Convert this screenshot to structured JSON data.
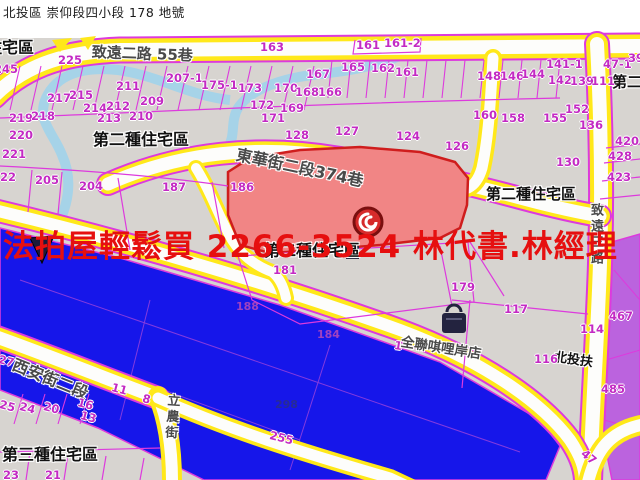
{
  "header": {
    "title": "北投區 崇仰段四小段 178 地號"
  },
  "overlay_ad": {
    "text": "法拍屋輕鬆買  2266-3524  林代書.林經理",
    "color": "#e60f0f"
  },
  "map": {
    "colors": {
      "parcel_line": "#dd3add",
      "road_yellow": "#ffe81a",
      "road_white": "#fdfdfb",
      "river_blue": "#1616ea",
      "creek_blue": "#a6d3e8",
      "block_gray": "#d7d4d0",
      "highlight_fill": "#f18585",
      "highlight_border": "#cf1d1d",
      "zone_purple": "#bb63de",
      "number_magenta": "#c32ac3"
    },
    "zone_labels": [
      {
        "text": "住宅區",
        "x": -14,
        "y": 40,
        "size": 16,
        "rot": 0
      },
      {
        "text": "第二種住宅區",
        "x": 93,
        "y": 132,
        "size": 16,
        "rot": 0
      },
      {
        "text": "第二種住宅區",
        "x": 264,
        "y": 243,
        "size": 16,
        "rot": 0
      },
      {
        "text": "第二種住宅區",
        "x": 486,
        "y": 187,
        "size": 15,
        "rot": 0
      },
      {
        "text": "第二",
        "x": 612,
        "y": 75,
        "size": 15,
        "rot": 0
      },
      {
        "text": "第三種住宅區",
        "x": 2,
        "y": 447,
        "size": 16,
        "rot": 0
      },
      {
        "text": "北投扶",
        "x": 555,
        "y": 351,
        "size": 13,
        "rot": 8
      }
    ],
    "street_labels": [
      {
        "text": "致遠二路 55巷",
        "x": 92,
        "y": 45,
        "size": 15,
        "rot": 2,
        "vert": false
      },
      {
        "text": "東華街二段374巷",
        "x": 238,
        "y": 147,
        "size": 16,
        "rot": 12,
        "vert": false
      },
      {
        "text": "西安街二段",
        "x": 16,
        "y": 357,
        "size": 16,
        "rot": 22,
        "vert": false
      },
      {
        "text": "立農街",
        "x": 166,
        "y": 393,
        "size": 13,
        "rot": 4,
        "vert": true
      },
      {
        "text": "致遠三路",
        "x": 589,
        "y": 203,
        "size": 13,
        "rot": 0,
        "vert": true
      }
    ],
    "poi_labels": [
      {
        "text": "全聯唭哩岸店",
        "x": 402,
        "y": 336,
        "size": 13.5,
        "rot": 9
      }
    ],
    "parcel_numbers": [
      {
        "n": "245",
        "x": -6,
        "y": 64
      },
      {
        "n": "225",
        "x": 58,
        "y": 55
      },
      {
        "n": "163",
        "x": 260,
        "y": 42
      },
      {
        "n": "161",
        "x": 356,
        "y": 40
      },
      {
        "n": "161-2",
        "x": 384,
        "y": 38
      },
      {
        "n": "167",
        "x": 306,
        "y": 69
      },
      {
        "n": "165",
        "x": 341,
        "y": 62
      },
      {
        "n": "162",
        "x": 371,
        "y": 63
      },
      {
        "n": "161",
        "x": 395,
        "y": 67
      },
      {
        "n": "166",
        "x": 318,
        "y": 87
      },
      {
        "n": "217",
        "x": 47,
        "y": 93
      },
      {
        "n": "215",
        "x": 69,
        "y": 90
      },
      {
        "n": "211",
        "x": 116,
        "y": 81
      },
      {
        "n": "214",
        "x": 83,
        "y": 103
      },
      {
        "n": "212",
        "x": 106,
        "y": 101
      },
      {
        "n": "209",
        "x": 140,
        "y": 96
      },
      {
        "n": "213",
        "x": 97,
        "y": 113
      },
      {
        "n": "210",
        "x": 129,
        "y": 111
      },
      {
        "n": "219",
        "x": 9,
        "y": 113
      },
      {
        "n": "218",
        "x": 31,
        "y": 111
      },
      {
        "n": "207-1",
        "x": 166,
        "y": 73
      },
      {
        "n": "175-1",
        "x": 201,
        "y": 80
      },
      {
        "n": "173",
        "x": 238,
        "y": 83
      },
      {
        "n": "170",
        "x": 274,
        "y": 83
      },
      {
        "n": "168",
        "x": 295,
        "y": 87
      },
      {
        "n": "172",
        "x": 250,
        "y": 100
      },
      {
        "n": "169",
        "x": 280,
        "y": 103
      },
      {
        "n": "171",
        "x": 261,
        "y": 113
      },
      {
        "n": "148",
        "x": 477,
        "y": 71
      },
      {
        "n": "146",
        "x": 500,
        "y": 71
      },
      {
        "n": "144",
        "x": 521,
        "y": 69
      },
      {
        "n": "141-1",
        "x": 546,
        "y": 59
      },
      {
        "n": "142",
        "x": 548,
        "y": 75
      },
      {
        "n": "139",
        "x": 570,
        "y": 76
      },
      {
        "n": "111",
        "x": 591,
        "y": 76
      },
      {
        "n": "47-1",
        "x": 603,
        "y": 59
      },
      {
        "n": "39",
        "x": 628,
        "y": 53
      },
      {
        "n": "160",
        "x": 473,
        "y": 110
      },
      {
        "n": "158",
        "x": 501,
        "y": 113
      },
      {
        "n": "155",
        "x": 543,
        "y": 113
      },
      {
        "n": "152",
        "x": 565,
        "y": 104
      },
      {
        "n": "136",
        "x": 579,
        "y": 120
      },
      {
        "n": "130",
        "x": 556,
        "y": 157
      },
      {
        "n": "420",
        "x": 615,
        "y": 136
      },
      {
        "n": "428",
        "x": 608,
        "y": 151
      },
      {
        "n": "423",
        "x": 607,
        "y": 172
      },
      {
        "n": "128",
        "x": 285,
        "y": 130
      },
      {
        "n": "127",
        "x": 335,
        "y": 126
      },
      {
        "n": "124",
        "x": 396,
        "y": 131
      },
      {
        "n": "126",
        "x": 445,
        "y": 141
      },
      {
        "n": "220",
        "x": 9,
        "y": 130
      },
      {
        "n": "221",
        "x": 2,
        "y": 149
      },
      {
        "n": "222",
        "x": -8,
        "y": 172
      },
      {
        "n": "205",
        "x": 35,
        "y": 175
      },
      {
        "n": "204",
        "x": 79,
        "y": 181
      },
      {
        "n": "187",
        "x": 162,
        "y": 182
      },
      {
        "n": "186",
        "x": 230,
        "y": 182
      },
      {
        "n": "181",
        "x": 273,
        "y": 265
      },
      {
        "n": "179",
        "x": 451,
        "y": 282
      },
      {
        "n": "117",
        "x": 504,
        "y": 304
      },
      {
        "n": "114",
        "x": 580,
        "y": 324
      },
      {
        "n": "116",
        "x": 534,
        "y": 354
      },
      {
        "n": "467",
        "x": 609,
        "y": 311
      },
      {
        "n": "485",
        "x": 601,
        "y": 384
      },
      {
        "n": "27",
        "x": 0,
        "y": 354,
        "rot": 15
      },
      {
        "n": "25",
        "x": 1,
        "y": 399,
        "rot": 15
      },
      {
        "n": "24",
        "x": 21,
        "y": 401,
        "rot": 15
      },
      {
        "n": "20",
        "x": 45,
        "y": 401,
        "rot": 15
      },
      {
        "n": "16",
        "x": 79,
        "y": 397,
        "rot": 15
      },
      {
        "n": "13",
        "x": 82,
        "y": 410,
        "rot": 15
      },
      {
        "n": "11",
        "x": 113,
        "y": 382,
        "rot": 15
      },
      {
        "n": "8",
        "x": 144,
        "y": 393,
        "rot": 15
      },
      {
        "n": "255",
        "x": 271,
        "y": 430,
        "rot": 14
      },
      {
        "n": "23",
        "x": 3,
        "y": 470
      },
      {
        "n": "21",
        "x": 45,
        "y": 470
      },
      {
        "n": "1",
        "x": 395,
        "y": 340,
        "rot": 9
      },
      {
        "n": "47",
        "x": 586,
        "y": 448,
        "rot": 40
      }
    ],
    "water_numbers": [
      {
        "n": "188",
        "x": 236,
        "y": 301,
        "color": "#b84ab8"
      },
      {
        "n": "184",
        "x": 317,
        "y": 329,
        "color": "#b84ab8"
      },
      {
        "n": "298",
        "x": 275,
        "y": 399,
        "color": "#2a2f88"
      }
    ],
    "icons": [
      {
        "name": "location-swirl-icon"
      },
      {
        "name": "store-bag-icon"
      },
      {
        "name": "building-icon"
      },
      {
        "name": "map-arrow-icon"
      }
    ]
  }
}
